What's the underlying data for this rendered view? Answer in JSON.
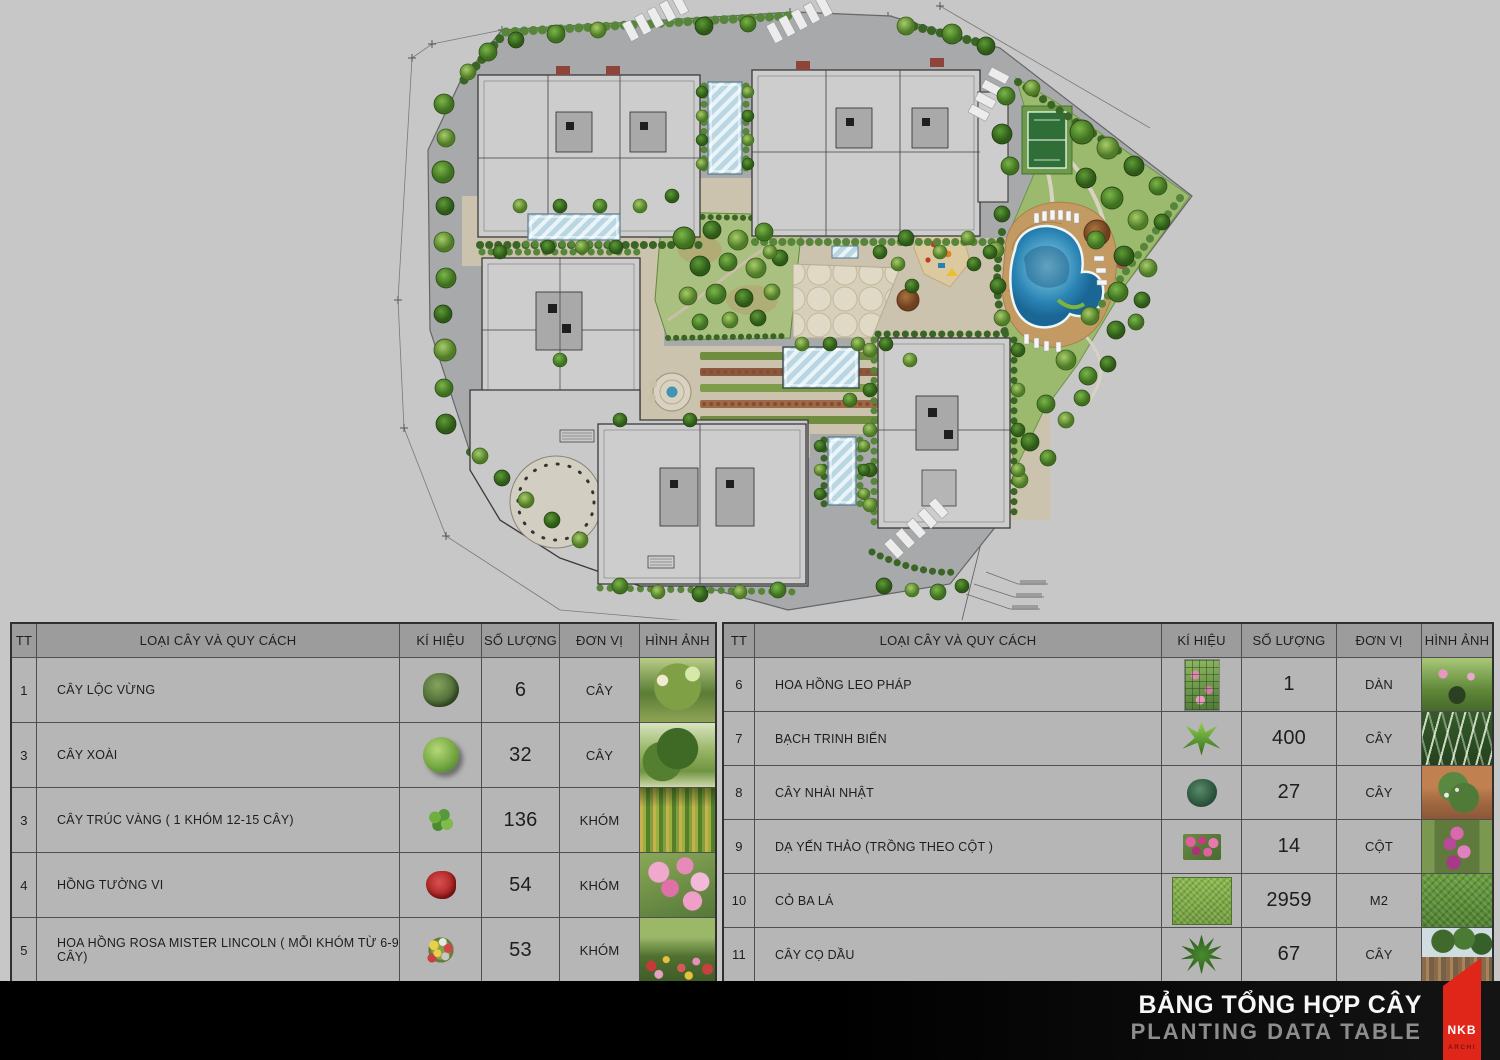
{
  "plan": {
    "features": [
      "site-boundary",
      "residential-buildings",
      "glass-canopies",
      "central-garden",
      "paved-plaza",
      "playground",
      "swimming-pool",
      "pool-deck",
      "tennis-court",
      "ornamental-garden",
      "flower-beds",
      "fountain",
      "parking-stalls",
      "perimeter-road",
      "street-trees",
      "survey-lines",
      "leader-notes"
    ]
  },
  "table": {
    "headers": {
      "tt": "TT",
      "name": "LOẠI CÂY VÀ QUY CÁCH",
      "symbol": "KÍ HIỆU",
      "qty": "SỐ LƯỢNG",
      "unit": "ĐƠN VỊ",
      "photo": "HÌNH ẢNH"
    },
    "left_rows": [
      {
        "tt": "1",
        "name": "CÂY LỘC VỪNG",
        "qty": "6",
        "unit": "CÂY",
        "symbol_icon": "broadleaf-tree-icon",
        "photo_icon": "photo-loc-vung"
      },
      {
        "tt": "3",
        "name": "CÂY XOÀI",
        "qty": "32",
        "unit": "CÂY",
        "symbol_icon": "mango-tree-icon",
        "photo_icon": "photo-mango"
      },
      {
        "tt": "3",
        "name": "CÂY TRÚC VÀNG ( 1 KHÓM 12-15 CÂY)",
        "qty": "136",
        "unit": "KHÓM",
        "symbol_icon": "bamboo-clump-icon",
        "photo_icon": "photo-bamboo"
      },
      {
        "tt": "4",
        "name": "HỒNG TƯỜNG VI",
        "qty": "54",
        "unit": "KHÓM",
        "symbol_icon": "red-flower-clump-icon",
        "photo_icon": "photo-crape-myrtle"
      },
      {
        "tt": "5",
        "name": "HOA HỒNG ROSA MISTER LINCOLN ( MỖI KHÓM TỪ 6-9 CÂY)",
        "qty": "53",
        "unit": "KHÓM",
        "symbol_icon": "mixed-rose-clump-icon",
        "photo_icon": "photo-rose-field"
      }
    ],
    "right_rows": [
      {
        "tt": "6",
        "name": "HOA HỒNG LEO PHÁP",
        "qty": "1",
        "unit": "DÀN",
        "symbol_icon": "rose-trellis-icon",
        "photo_icon": "photo-rose-arch"
      },
      {
        "tt": "7",
        "name": "BẠCH TRINH BIỂN",
        "qty": "400",
        "unit": "CÂY",
        "symbol_icon": "spider-lily-icon",
        "photo_icon": "photo-spider-lily"
      },
      {
        "tt": "8",
        "name": "CÂY NHÀI NHẬT",
        "qty": "27",
        "unit": "CÂY",
        "symbol_icon": "jasmine-bush-icon",
        "photo_icon": "photo-jasmine"
      },
      {
        "tt": "9",
        "name": "DẠ YẾN THẢO (TRỒNG THEO CỘT )",
        "qty": "14",
        "unit": "CỘT",
        "symbol_icon": "petunia-patch-icon",
        "photo_icon": "photo-petunia-column"
      },
      {
        "tt": "10",
        "name": "CỎ BA LÁ",
        "qty": "2959",
        "unit": "M2",
        "symbol_icon": "grass-swatch-icon",
        "photo_icon": "photo-clover"
      },
      {
        "tt": "11",
        "name": "CÂY CỌ DẦU",
        "qty": "67",
        "unit": "CÂY",
        "symbol_icon": "oil-palm-icon",
        "photo_icon": "photo-oil-palm"
      }
    ]
  },
  "footer": {
    "title_vi": "BẢNG TỔNG HỢP CÂY",
    "title_en": "PLANTING DATA TABLE"
  },
  "logo": {
    "name": "NKB",
    "sub": "ARCHI"
  },
  "colors": {
    "page_bg": "#c7c7c7",
    "table_header_bg": "#9c9c9c",
    "table_row_bg": "#b6b6b6",
    "footer_bg": "#050505",
    "logo_red": "#e02619",
    "pool_blue": "#2a84b4",
    "tennis_green": "#2f6e37",
    "deck_tan": "#c49a63"
  }
}
